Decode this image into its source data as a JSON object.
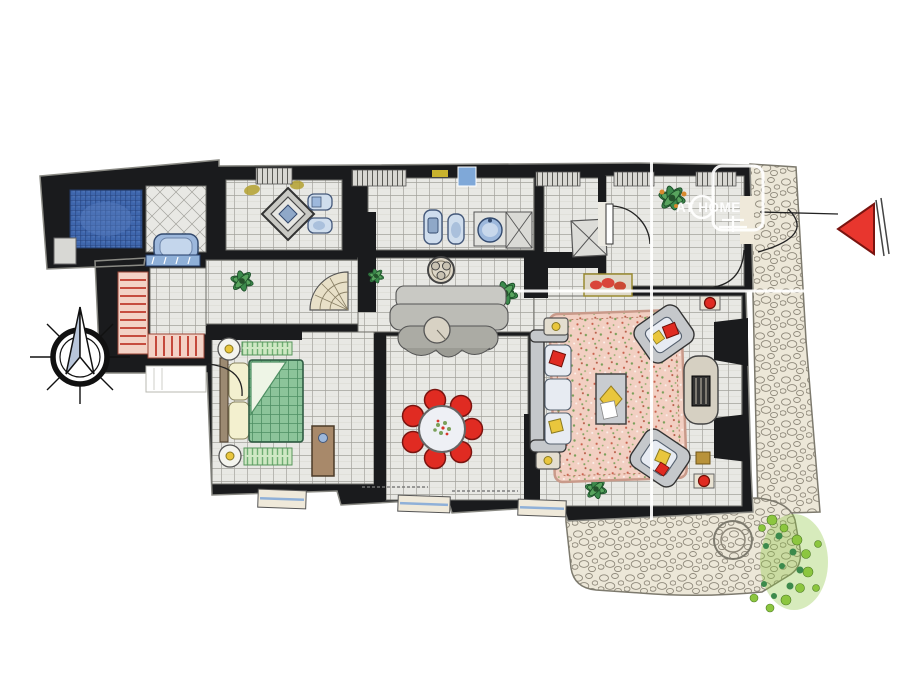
{
  "watermark": {
    "brand": "AT HOME"
  },
  "colors": {
    "wall": "#1a1b1d",
    "floor": "#e8e8e4",
    "floorline": "#96958f",
    "shower": "#3e66ad",
    "tub": "#9db8dc",
    "fixture": "#cfdded",
    "stair": "#f3d2c6",
    "tread": "#c03a2c",
    "bed": "#8cc49a",
    "mat": "#cfe8c4",
    "pillow": "#f3f0cf",
    "rug": "#f2cfc2",
    "chair": "#e02b22",
    "sofa": "#c5c8cb",
    "cushion": "#e7ebf2",
    "counter": "#bfbfb9",
    "stone": "#ece7d8",
    "cobble": "#8e887a",
    "bush": "#8cc63f",
    "leaf": "#3c8a4c",
    "wood": "#a8896a",
    "accent": "#e9c63d",
    "arrow": "#e8362e",
    "needle": "#b9c6da",
    "sill": "#efe9da",
    "watermark": "#ffffff"
  }
}
